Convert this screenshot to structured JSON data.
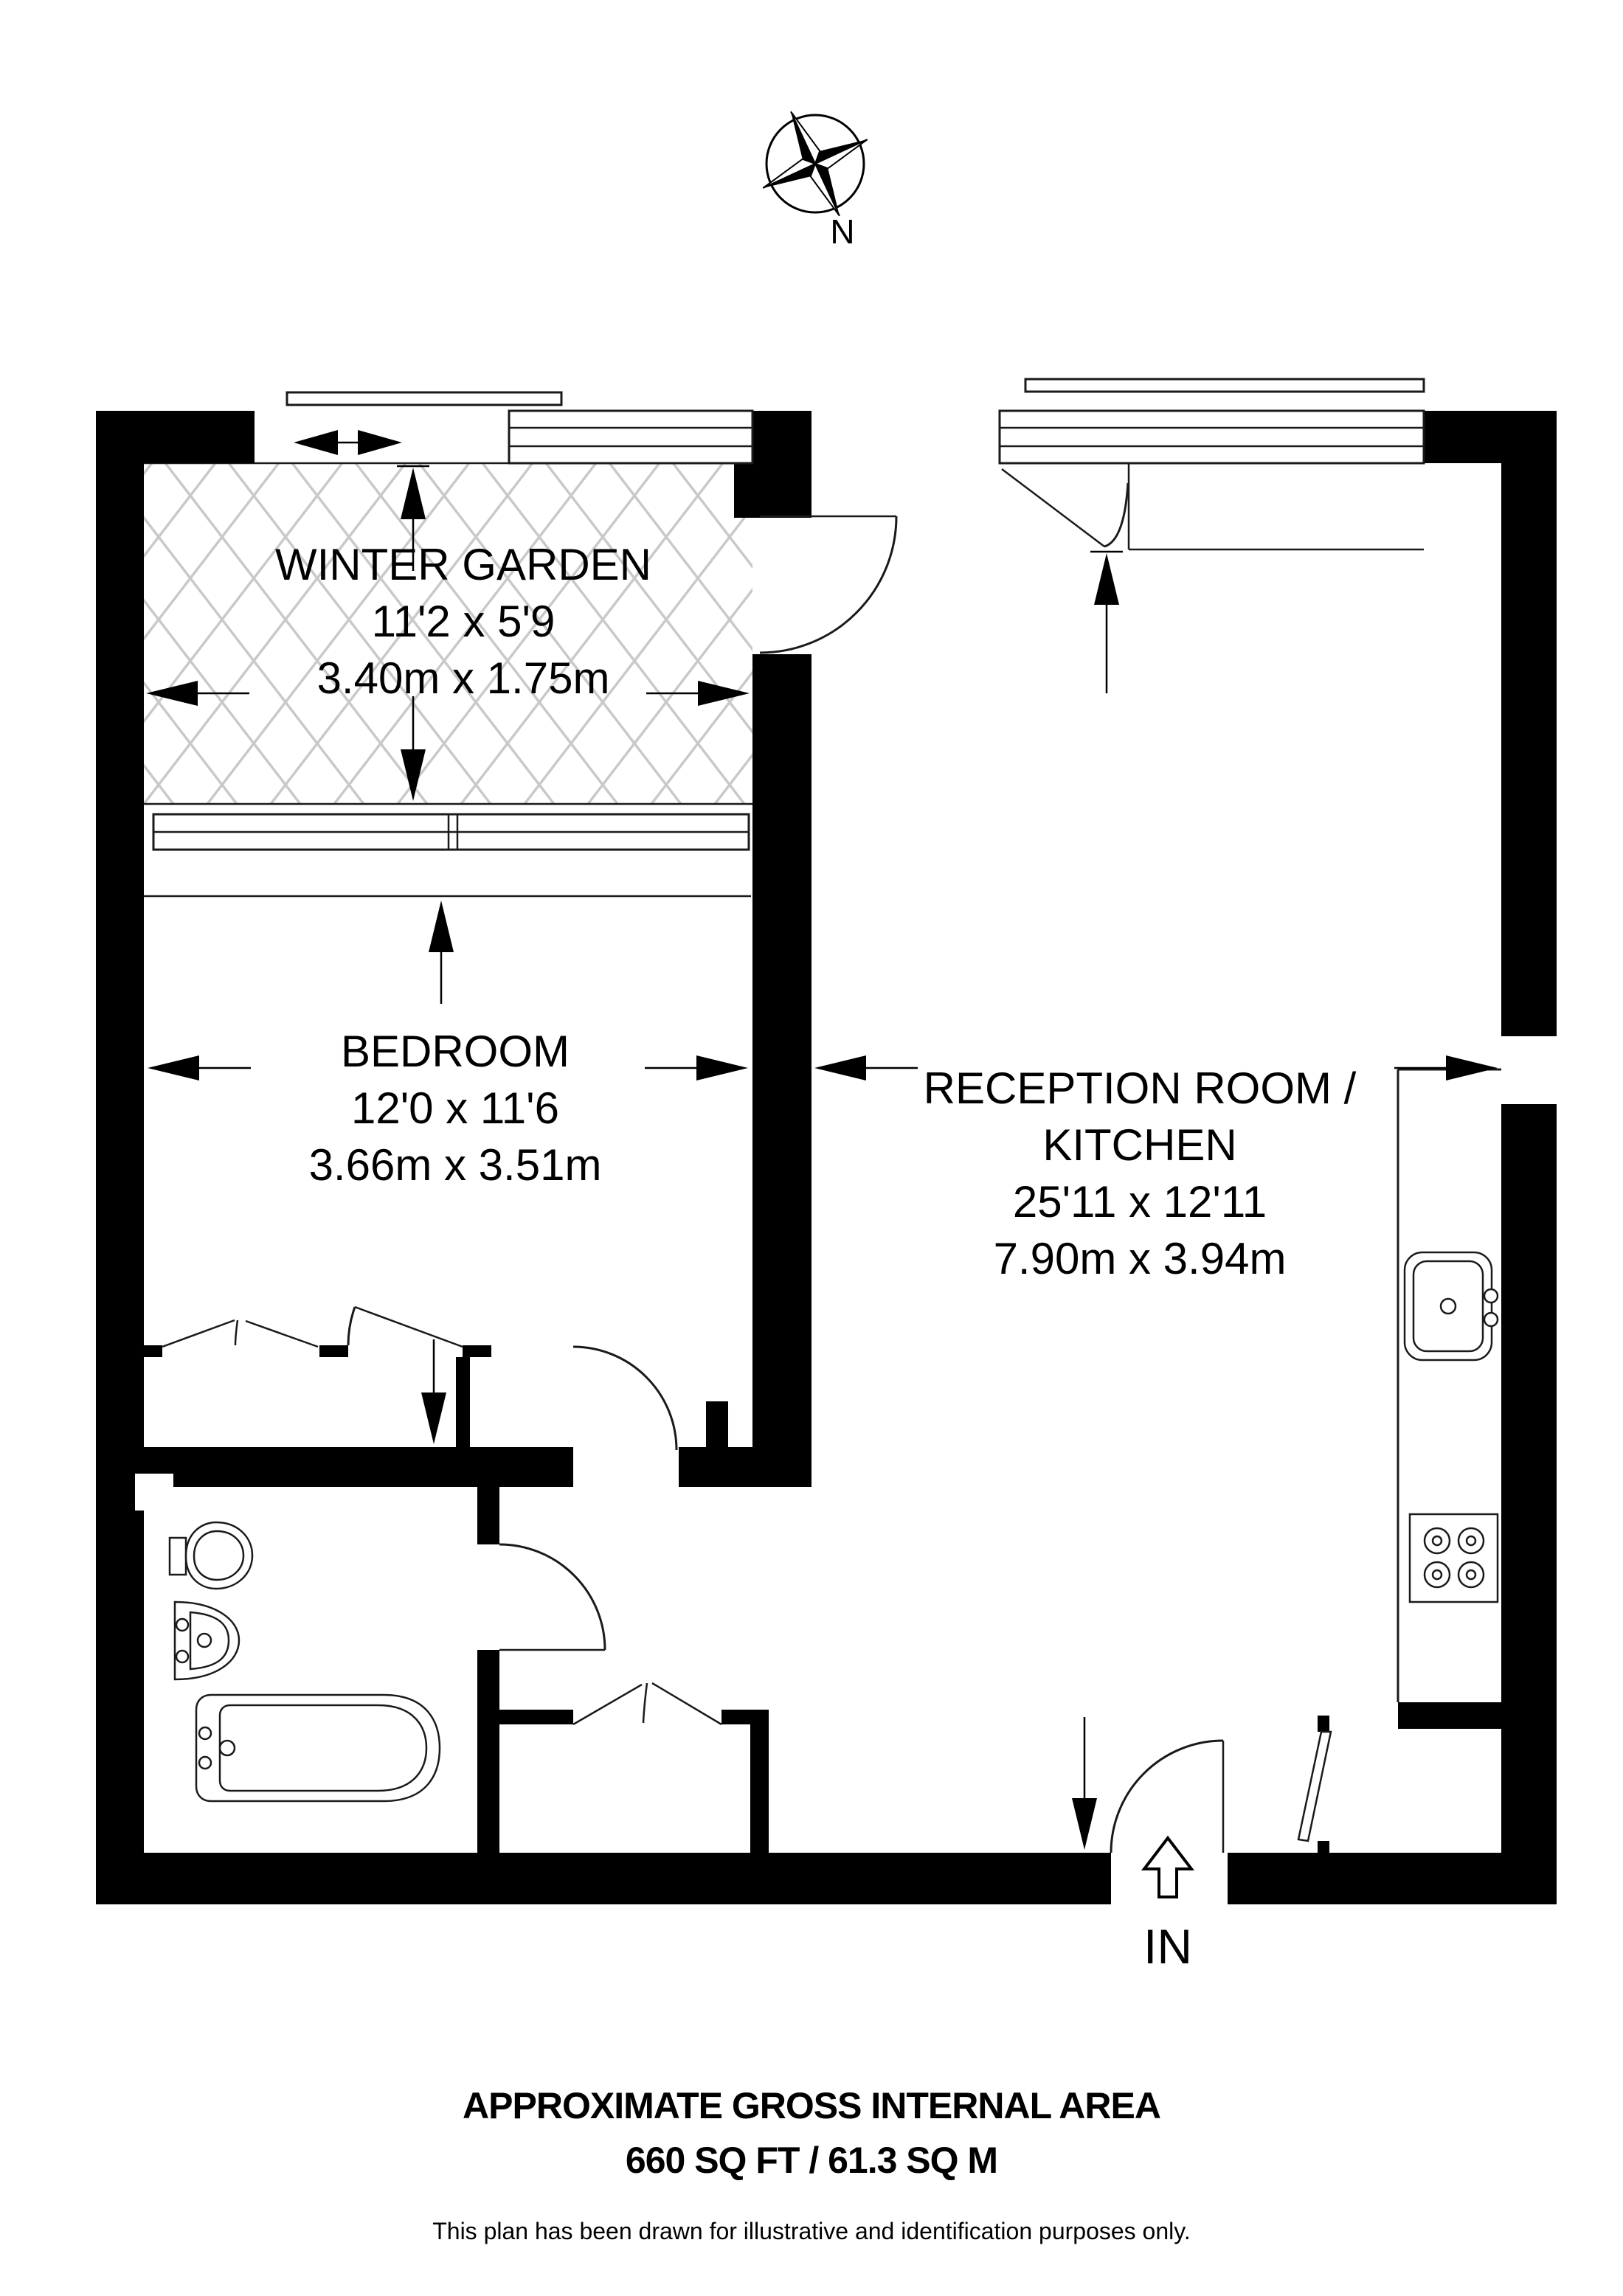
{
  "compass": {
    "north_label": "N"
  },
  "rooms": {
    "winter_garden": {
      "name": "WINTER GARDEN",
      "imperial": "11'2 x 5'9",
      "metric": "3.40m x 1.75m"
    },
    "bedroom": {
      "name": "BEDROOM",
      "imperial": "12'0 x 11'6",
      "metric": "3.66m x 3.51m"
    },
    "reception_kitchen": {
      "name_line1": "RECEPTION ROOM /",
      "name_line2": "KITCHEN",
      "imperial": "25'11 x 12'11",
      "metric": "7.90m x 3.94m"
    }
  },
  "entrance": {
    "label": "IN"
  },
  "footer": {
    "title": "APPROXIMATE GROSS INTERNAL AREA",
    "area": "660 SQ FT / 61.3 SQ M",
    "disclaimer": "This plan has been drawn for illustrative and identification purposes only."
  },
  "colors": {
    "wall": "#000000",
    "hatch": "#c9c9c9",
    "background": "#ffffff"
  }
}
